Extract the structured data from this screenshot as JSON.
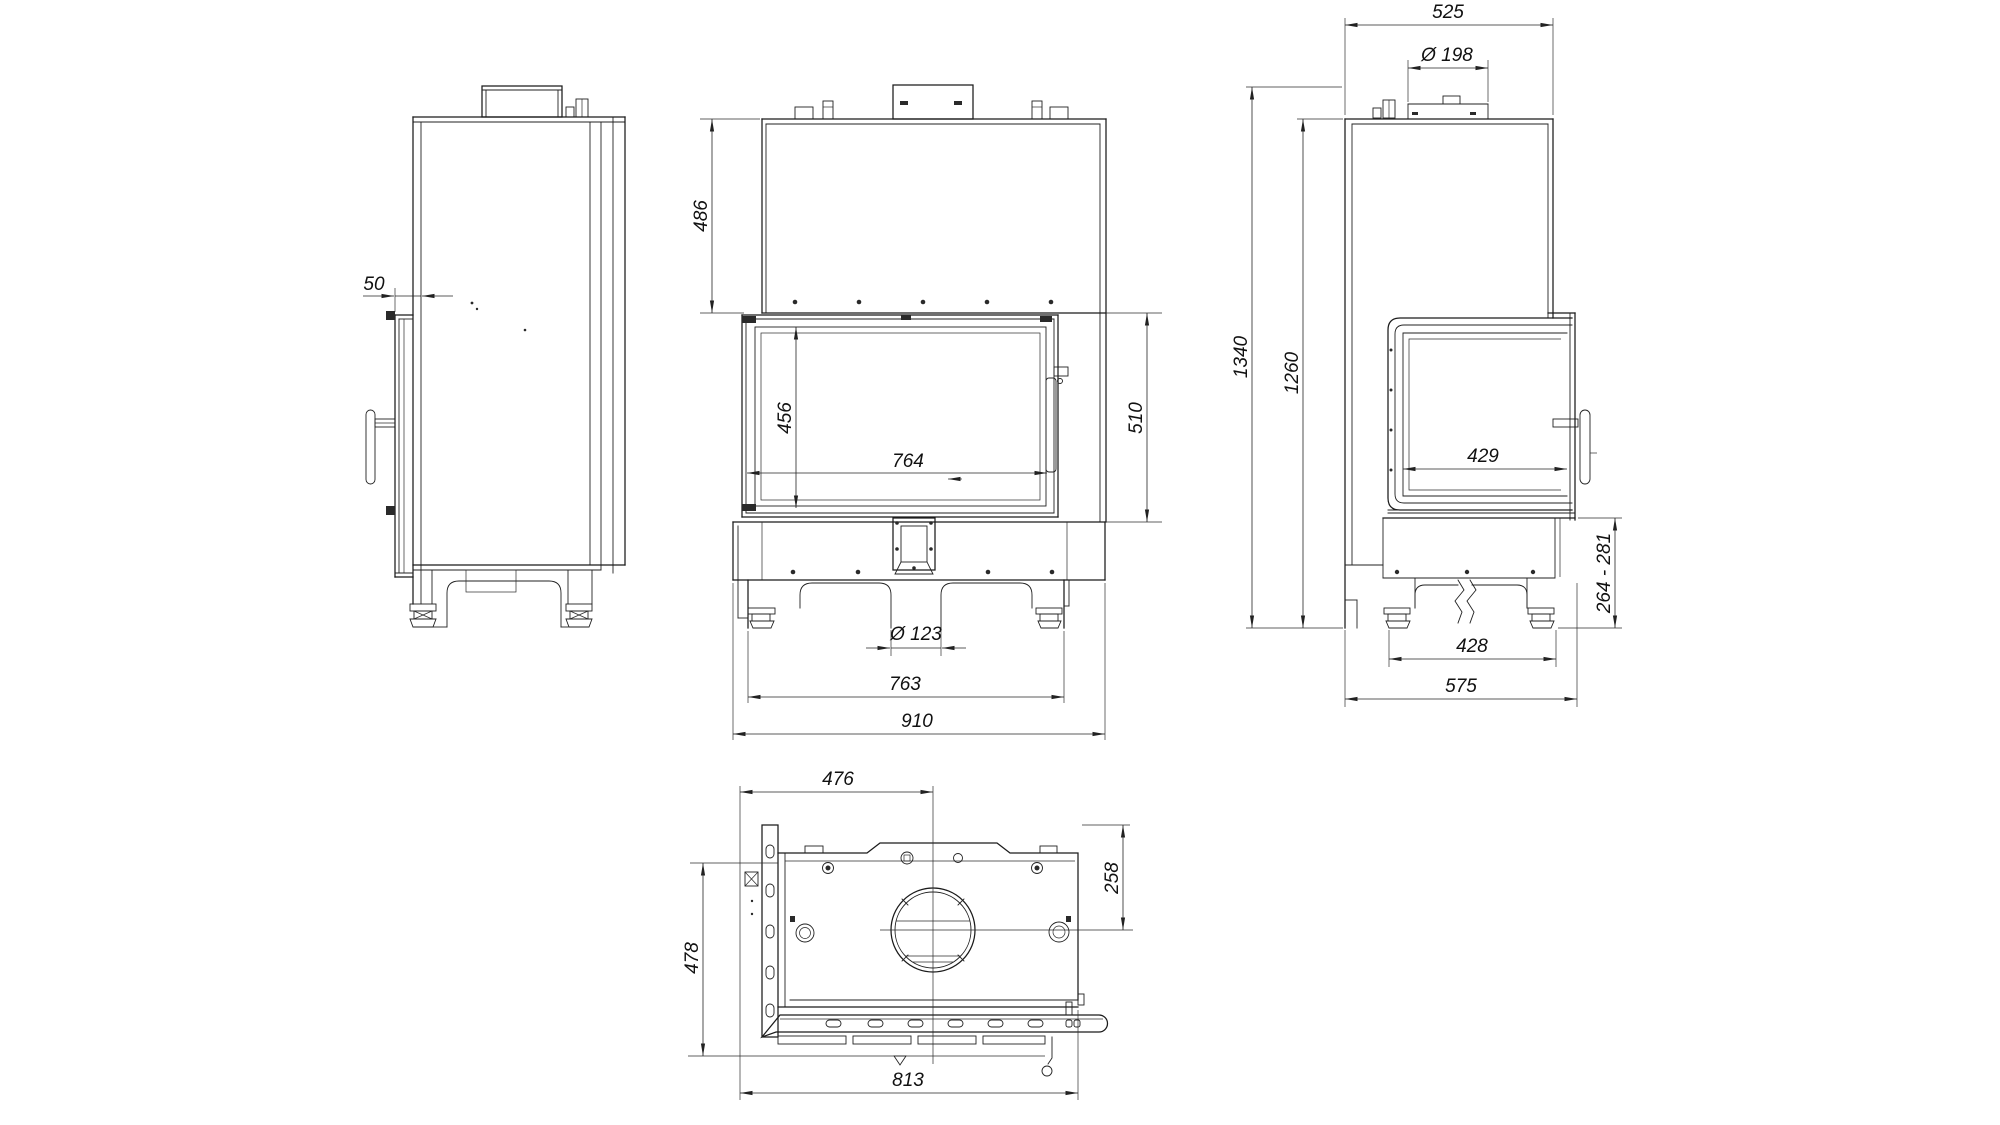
{
  "drawing": {
    "kind": "fireplace-insert-dimensional-drawing",
    "background": "#ffffff",
    "line_color": "#1b1b1b",
    "views": {
      "left_view": {
        "label": "side view (door edge)",
        "dims": {
          "door_protrusion": {
            "text": "50",
            "value": 50
          }
        }
      },
      "front_view": {
        "label": "front view",
        "dims": {
          "hood_height": {
            "text": "486",
            "value": 486
          },
          "glass_height": {
            "text": "456",
            "value": 456
          },
          "glass_width": {
            "text": "764",
            "value": 764
          },
          "door_height": {
            "text": "510",
            "value": 510
          },
          "air_inlet": {
            "text": "Ø 123",
            "value": 123
          },
          "feet_span": {
            "text": "763",
            "value": 763
          },
          "overall_width": {
            "text": "910",
            "value": 910
          }
        }
      },
      "right_view": {
        "label": "side view (side glass)",
        "dims": {
          "depth": {
            "text": "525",
            "value": 525
          },
          "flue_diameter": {
            "text": "Ø 198",
            "value": 198
          },
          "overall_height": {
            "text": "1340",
            "value": 1340
          },
          "body_height": {
            "text": "1260",
            "value": 1260
          },
          "side_glass_width": {
            "text": "429",
            "value": 429
          },
          "plinth_height": {
            "text": "264 - 281",
            "min": 264,
            "max": 281
          },
          "feet_distance": {
            "text": "428",
            "value": 428
          },
          "base_depth": {
            "text": "575",
            "value": 575
          }
        }
      },
      "top_view": {
        "label": "top view",
        "dims": {
          "flue_offset_side": {
            "text": "476",
            "value": 476
          },
          "flue_offset_back": {
            "text": "258",
            "value": 258
          },
          "body_depth": {
            "text": "478",
            "value": 478
          },
          "body_width": {
            "text": "813",
            "value": 813
          }
        }
      }
    }
  }
}
